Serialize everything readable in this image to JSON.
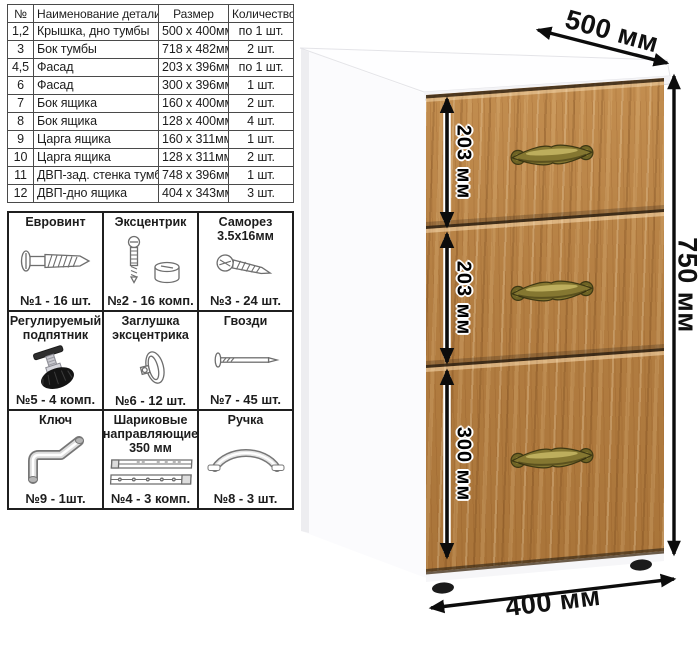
{
  "parts_table": {
    "headers": [
      "№",
      "Наименование детали",
      "Размер",
      "Количество"
    ],
    "rows": [
      [
        "1,2",
        "Крышка, дно тумбы",
        "500 x 400мм",
        "по 1 шт."
      ],
      [
        "3",
        "Бок тумбы",
        "718 x 482мм",
        "2 шт."
      ],
      [
        "4,5",
        "Фасад",
        "203 x 396мм",
        "по 1 шт."
      ],
      [
        "6",
        "Фасад",
        "300 x 396мм",
        "1 шт."
      ],
      [
        "7",
        "Бок ящика",
        "160 x 400мм",
        "2 шт."
      ],
      [
        "8",
        "Бок ящика",
        "128 x 400мм",
        "4 шт."
      ],
      [
        "9",
        "Царга ящика",
        "160 x 311мм",
        "1 шт."
      ],
      [
        "10",
        "Царга ящика",
        "128 x 311мм",
        "2 шт."
      ],
      [
        "11",
        "ДВП-зад. стенка тумбы",
        "748 x 396мм",
        "1 шт."
      ],
      [
        "12",
        "ДВП-дно ящика",
        "404 x 343мм",
        "3 шт."
      ]
    ]
  },
  "hardware": {
    "items": [
      {
        "title": "Евровинт",
        "count": "№1 - 16 шт.",
        "icon": "euro-screw"
      },
      {
        "title": "Эксцентрик",
        "count": "№2 - 16 комп.",
        "icon": "cam-lock"
      },
      {
        "title": "Саморез 3.5х16мм",
        "count": "№3 - 24 шт.",
        "icon": "self-tapping-screw"
      },
      {
        "title": "Регулируемый подпятник",
        "count": "№5 - 4 комп.",
        "icon": "adjustable-foot"
      },
      {
        "title": "Заглушка эксцентрика",
        "count": "№6 - 12 шт.",
        "icon": "cam-cover"
      },
      {
        "title": "Гвозди",
        "count": "№7 - 45 шт.",
        "icon": "nail"
      },
      {
        "title": "Ключ",
        "count": "№9 - 1шт.",
        "icon": "hex-key"
      },
      {
        "title": "Шариковые направляющие 350 мм",
        "count": "№4 - 3 комп.",
        "icon": "ball-slides"
      },
      {
        "title": "Ручка",
        "count": "№8 - 3 шт.",
        "icon": "bow-handle"
      }
    ]
  },
  "dimensions": {
    "top_width": "500 мм",
    "height": "750 мм",
    "depth": "400 мм",
    "drawers": [
      "203 мм",
      "203 мм",
      "300 мм"
    ]
  },
  "colors": {
    "wood": "#b37e42",
    "handle_brass": "#857731",
    "arrow": "#0c0c0c",
    "cabinet_white": "#fbfbfd"
  }
}
